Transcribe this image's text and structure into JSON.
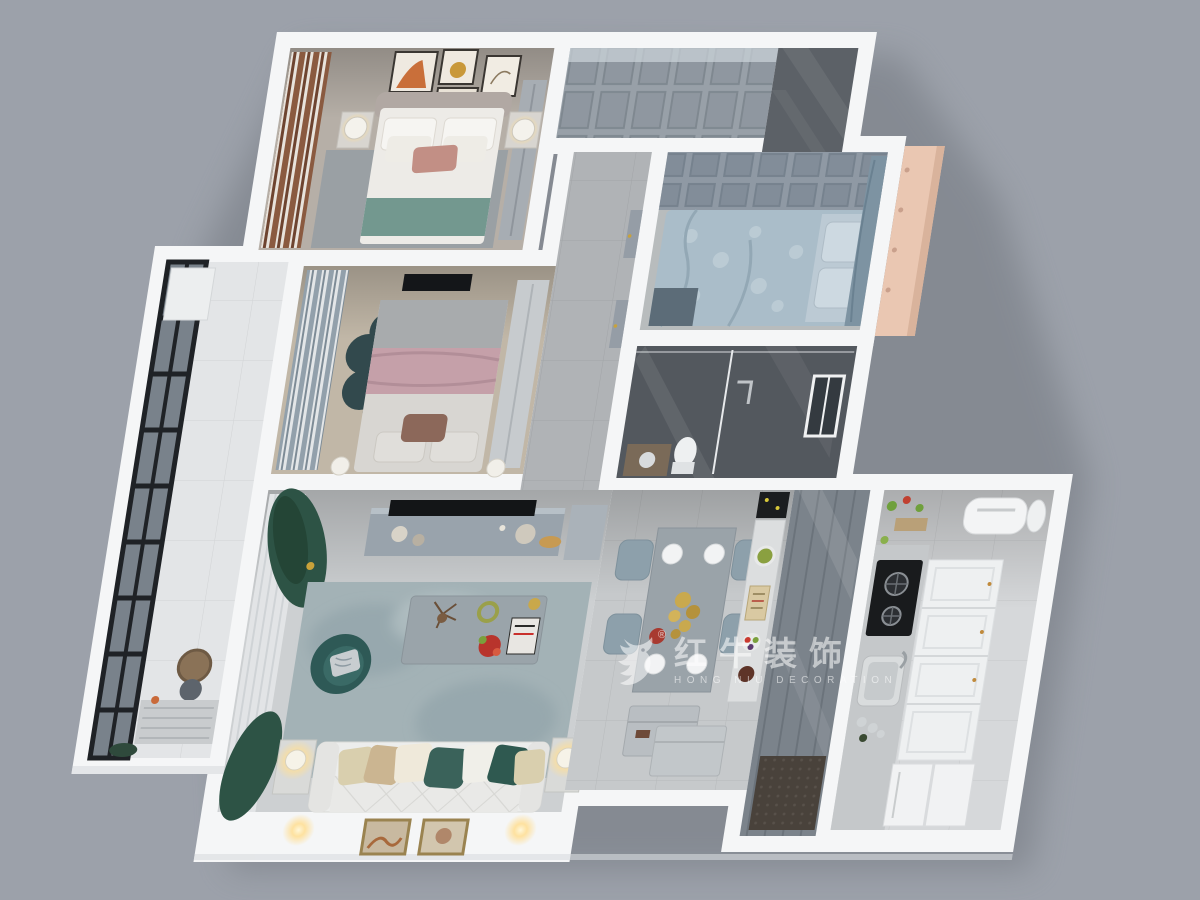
{
  "watermark": {
    "brand": "红牛装饰",
    "subtitle": "HONG NIU DECORATION",
    "registered": "®",
    "logo_icon": "bull-logo-icon",
    "color": "#ffffff"
  },
  "scene": {
    "type": "3d-floor-plan-render",
    "view": "top-down cutaway apartment",
    "background_color": "#9ca1aa",
    "wall_color": "#f5f6f7",
    "accent_teal": "#2e5956",
    "accent_green_curtain": "#2d5345",
    "accent_pink": "#c5a0a9",
    "accent_peach_window_box": "#eac7b2",
    "accent_gold": "#c9a94e",
    "rooms": [
      {
        "name": "master-bedroom",
        "floor": "#b6afa7",
        "items": [
          "double-bed",
          "teal-throw",
          "nightstands",
          "table-lamps",
          "wall-art-frames",
          "striped-curtains",
          "wardrobe",
          "rug"
        ]
      },
      {
        "name": "second-bedroom",
        "floor": "#c1b7a7",
        "items": [
          "bed-pink-blanket",
          "flower-rug",
          "sliding-wardrobe",
          "wall-tv",
          "curtains"
        ]
      },
      {
        "name": "balcony",
        "floor": "#e3e5e7",
        "items": [
          "black-frame-windows",
          "basket",
          "robot-vacuum",
          "bench"
        ]
      },
      {
        "name": "hallway-wardrobe",
        "floor": "#99a0a7",
        "items": [
          "paneled-cabinets"
        ]
      },
      {
        "name": "foyer",
        "floor": "#5c6167",
        "items": [
          "dark-tiles"
        ]
      },
      {
        "name": "corridor",
        "floor": "#b0b3b6",
        "items": [
          "doors"
        ]
      },
      {
        "name": "tatami-bedroom",
        "floor": "#b8bcbd",
        "items": [
          "blue-bed",
          "paneled-wardrobe",
          "curtain",
          "peach-window-box"
        ]
      },
      {
        "name": "bathroom",
        "floor": "#53585e",
        "items": [
          "glass-shower",
          "toilet",
          "window",
          "vanity"
        ]
      },
      {
        "name": "living-room",
        "floor": "#cdd0d2",
        "items": [
          "tv-console",
          "tv",
          "area-rug",
          "coffee-table",
          "teal-armchair",
          "white-sofa",
          "pillows",
          "side-tables",
          "glow-lamps",
          "green-curtains",
          "framed-pictures",
          "sconces"
        ]
      },
      {
        "name": "dining-room",
        "floor": "#c6c9cb",
        "items": [
          "dining-table",
          "four-chairs",
          "place-settings",
          "gold-centerpiece",
          "sideboard",
          "built-in-oven",
          "shoe-cabinets"
        ]
      },
      {
        "name": "kitchen",
        "floor": "#d6d8da",
        "items": [
          "gas-stove",
          "sink",
          "counter",
          "drawer-cabinets",
          "fridge",
          "air-conditioner",
          "door-mat",
          "glass-partition"
        ]
      }
    ]
  }
}
